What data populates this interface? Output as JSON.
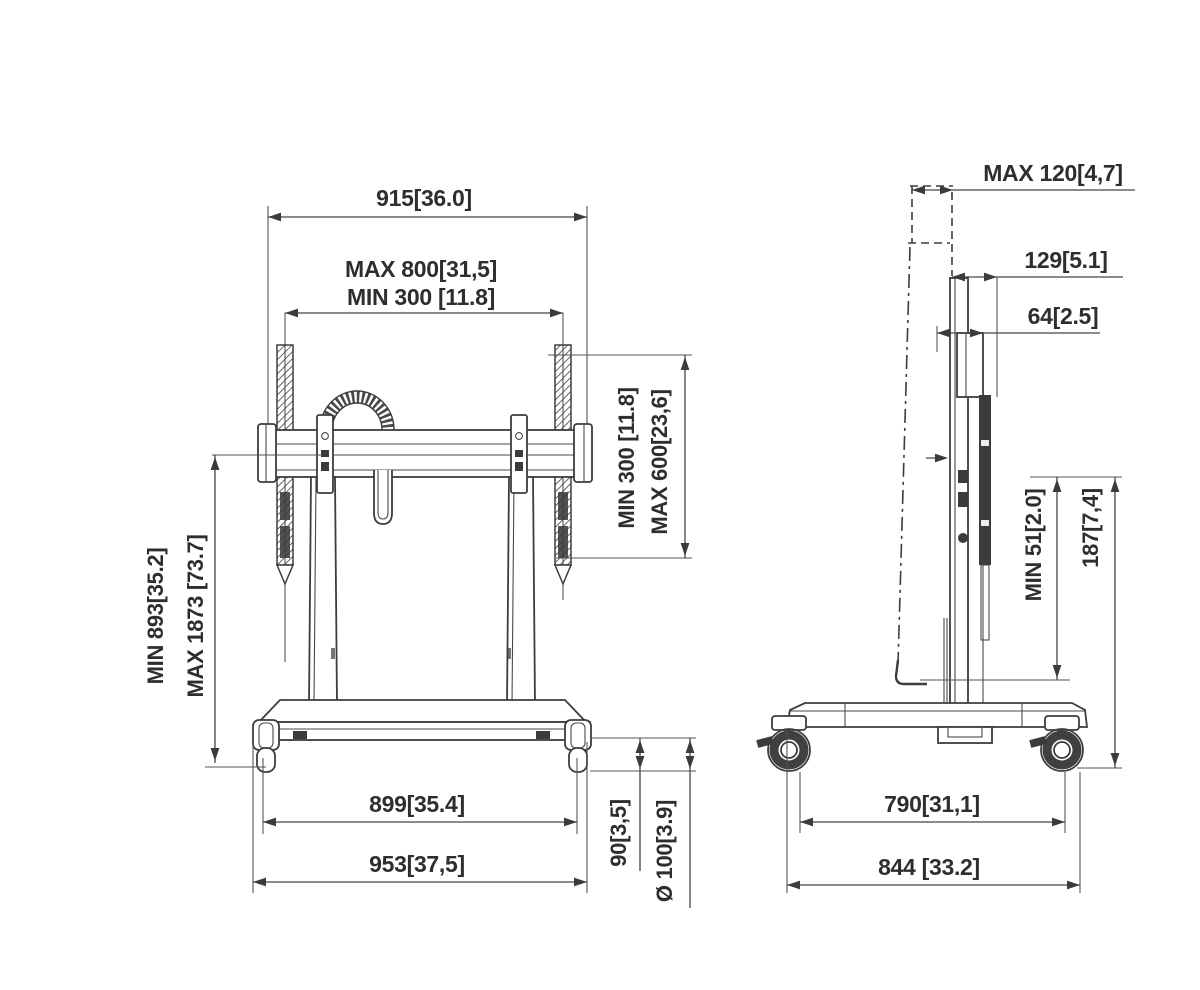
{
  "drawing": {
    "title": "tv-cart-dimension-drawing",
    "ink_color": "#3a3a3a",
    "background": "#ffffff"
  },
  "front_view": {
    "dims": {
      "width_total": "915[36.0]",
      "vesa_width_max": "MAX 800[31,5]",
      "vesa_width_min": "MIN 300 [11.8]",
      "height_min": "MIN 893[35.2]",
      "height_max": "MAX 1873 [73.7]",
      "vesa_height_min": "MIN 300 [11.8]",
      "vesa_height_max": "MAX 600[23,6]",
      "base_inner_width": "899[35.4]",
      "base_width": "953[37,5]",
      "caster_clearance": "90[3,5]",
      "caster_diameter": "Ø 100[3.9]"
    }
  },
  "side_view": {
    "dims": {
      "tilt_depth_max": "MAX 120[4,7]",
      "depth_top": "129[5.1]",
      "column_depth": "64[2.5]",
      "gap_min": "MIN 51[2.0]",
      "base_height": "187[7,4]",
      "wheelbase": "790[31,1]",
      "base_depth": "844 [33.2]"
    }
  }
}
